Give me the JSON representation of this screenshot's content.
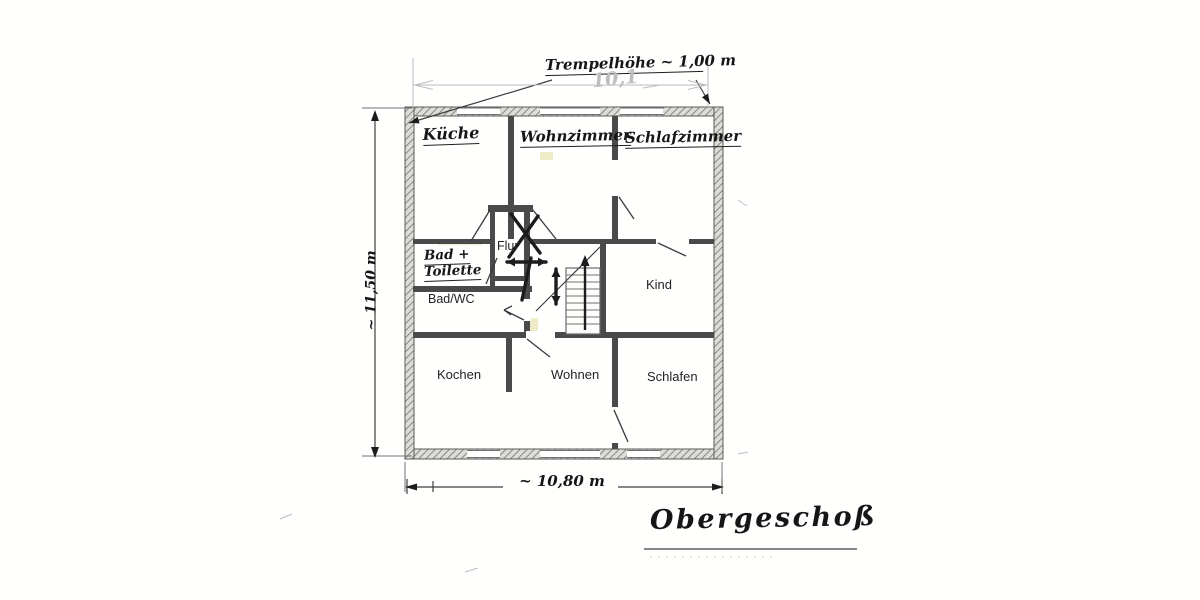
{
  "drawing": {
    "floor_title": "Obergeschoß",
    "knee_wall_note": "Trempelhöhe ~ 1,00 m",
    "dim_top_faint": "10,1",
    "dim_left": "~ 11,50 m",
    "dim_bottom": "~ 10,80 m"
  },
  "rooms": {
    "kueche": "Küche",
    "wohnzimmer": "Wohnzimmer",
    "schlafzimmer": "Schlafzimmer",
    "flur": "Flur",
    "bad_line1": "Bad +",
    "bad_line2": "Toilette",
    "bad_wc": "Bad/WC",
    "kind": "Kind",
    "kochen": "Kochen",
    "wohnen": "Wohnen",
    "schlafen": "Schlafen"
  },
  "colors": {
    "pencil": "#3f3f3f",
    "ink": "#1c1c1c",
    "faint_print": "#bdbdbd",
    "highlight": "#c4bc4d",
    "paper": "#fffffe"
  },
  "plan_geometry": {
    "rects": [
      {
        "x": 438,
        "y": 239,
        "w": 44,
        "h": 6,
        "c": "tint"
      },
      {
        "x": 524,
        "y": 318,
        "w": 14,
        "h": 16,
        "c": "tint"
      },
      {
        "x": 540,
        "y": 152,
        "w": 13,
        "h": 8,
        "c": "tint"
      },
      {
        "x": 405,
        "y": 107,
        "w": 318,
        "h": 9,
        "c": "wo"
      },
      {
        "x": 405,
        "y": 449,
        "w": 318,
        "h": 10,
        "c": "wo"
      },
      {
        "x": 405,
        "y": 107,
        "w": 9,
        "h": 352,
        "c": "wo"
      },
      {
        "x": 714,
        "y": 107,
        "w": 9,
        "h": 352,
        "c": "wo"
      },
      {
        "x": 413,
        "y": 239,
        "w": 77,
        "h": 5,
        "c": "wi"
      },
      {
        "x": 530,
        "y": 239,
        "w": 126,
        "h": 5,
        "c": "wi"
      },
      {
        "x": 689,
        "y": 239,
        "w": 25,
        "h": 5,
        "c": "wi"
      },
      {
        "x": 508,
        "y": 116,
        "w": 6,
        "h": 123,
        "c": "wi"
      },
      {
        "x": 612,
        "y": 116,
        "w": 6,
        "h": 123,
        "c": "wi"
      },
      {
        "x": 413,
        "y": 286,
        "w": 119,
        "h": 6,
        "c": "wi"
      },
      {
        "x": 524,
        "y": 212,
        "w": 6,
        "h": 122,
        "c": "wi"
      },
      {
        "x": 490,
        "y": 212,
        "w": 5,
        "h": 74,
        "c": "wi"
      },
      {
        "x": 488,
        "y": 205,
        "w": 45,
        "h": 7,
        "c": "wi"
      },
      {
        "x": 492,
        "y": 276,
        "w": 38,
        "h": 5,
        "c": "wi"
      },
      {
        "x": 600,
        "y": 244,
        "w": 6,
        "h": 90,
        "c": "wi"
      },
      {
        "x": 413,
        "y": 332,
        "w": 301,
        "h": 6,
        "c": "wi"
      },
      {
        "x": 506,
        "y": 338,
        "w": 6,
        "h": 54,
        "c": "wi"
      },
      {
        "x": 612,
        "y": 338,
        "w": 6,
        "h": 111,
        "c": "wi"
      },
      {
        "x": 457,
        "y": 108,
        "w": 43,
        "h": 7,
        "c": "win"
      },
      {
        "x": 540,
        "y": 108,
        "w": 60,
        "h": 7,
        "c": "win"
      },
      {
        "x": 620,
        "y": 108,
        "w": 43,
        "h": 7,
        "c": "win"
      },
      {
        "x": 467,
        "y": 450,
        "w": 33,
        "h": 8,
        "c": "win"
      },
      {
        "x": 540,
        "y": 450,
        "w": 60,
        "h": 8,
        "c": "win"
      },
      {
        "x": 627,
        "y": 450,
        "w": 33,
        "h": 8,
        "c": "win"
      },
      {
        "x": 611,
        "y": 160,
        "w": 8,
        "h": 36,
        "c": "win"
      },
      {
        "x": 523,
        "y": 299,
        "w": 8,
        "h": 22,
        "c": "win"
      },
      {
        "x": 526,
        "y": 331,
        "w": 29,
        "h": 8,
        "c": "win"
      },
      {
        "x": 611,
        "y": 407,
        "w": 8,
        "h": 36,
        "c": "win"
      },
      {
        "x": 566,
        "y": 268,
        "w": 34,
        "h": 66,
        "c": "st"
      }
    ],
    "lines": [
      {
        "x1": 457,
        "y1": 108,
        "x2": 500,
        "y2": 108,
        "c": "thin"
      },
      {
        "x1": 457,
        "y1": 114.5,
        "x2": 500,
        "y2": 114.5,
        "c": "thin"
      },
      {
        "x1": 540,
        "y1": 108,
        "x2": 600,
        "y2": 108,
        "c": "thin"
      },
      {
        "x1": 540,
        "y1": 114.5,
        "x2": 600,
        "y2": 114.5,
        "c": "thin"
      },
      {
        "x1": 620,
        "y1": 108,
        "x2": 663,
        "y2": 108,
        "c": "thin"
      },
      {
        "x1": 620,
        "y1": 114.5,
        "x2": 663,
        "y2": 114.5,
        "c": "thin"
      },
      {
        "x1": 467,
        "y1": 450.5,
        "x2": 500,
        "y2": 450.5,
        "c": "thin"
      },
      {
        "x1": 467,
        "y1": 457.5,
        "x2": 500,
        "y2": 457.5,
        "c": "thin"
      },
      {
        "x1": 540,
        "y1": 450.5,
        "x2": 600,
        "y2": 450.5,
        "c": "thin"
      },
      {
        "x1": 540,
        "y1": 457.5,
        "x2": 600,
        "y2": 457.5,
        "c": "thin"
      },
      {
        "x1": 627,
        "y1": 450.5,
        "x2": 660,
        "y2": 450.5,
        "c": "thin"
      },
      {
        "x1": 627,
        "y1": 457.5,
        "x2": 660,
        "y2": 457.5,
        "c": "thin"
      },
      {
        "x1": 566,
        "y1": 275,
        "x2": 600,
        "y2": 275,
        "c": "thin"
      },
      {
        "x1": 566,
        "y1": 282,
        "x2": 600,
        "y2": 282,
        "c": "thin"
      },
      {
        "x1": 566,
        "y1": 289,
        "x2": 600,
        "y2": 289,
        "c": "thin"
      },
      {
        "x1": 566,
        "y1": 296,
        "x2": 600,
        "y2": 296,
        "c": "thin"
      },
      {
        "x1": 566,
        "y1": 303,
        "x2": 600,
        "y2": 303,
        "c": "thin"
      },
      {
        "x1": 566,
        "y1": 310,
        "x2": 600,
        "y2": 310,
        "c": "thin"
      },
      {
        "x1": 566,
        "y1": 317,
        "x2": 600,
        "y2": 317,
        "c": "thin"
      },
      {
        "x1": 566,
        "y1": 324,
        "x2": 600,
        "y2": 324,
        "c": "thin"
      },
      {
        "x1": 619,
        "y1": 197,
        "x2": 634,
        "y2": 219,
        "c": "swing"
      },
      {
        "x1": 658,
        "y1": 243,
        "x2": 686,
        "y2": 256,
        "c": "swing"
      },
      {
        "x1": 524,
        "y1": 320,
        "x2": 504,
        "y2": 310,
        "c": "swing"
      },
      {
        "x1": 504,
        "y1": 310,
        "x2": 512,
        "y2": 306,
        "c": "swing"
      },
      {
        "x1": 504,
        "y1": 310,
        "x2": 511,
        "y2": 315,
        "c": "swing"
      },
      {
        "x1": 527,
        "y1": 339,
        "x2": 550,
        "y2": 357,
        "c": "swing"
      },
      {
        "x1": 614,
        "y1": 410,
        "x2": 628,
        "y2": 442,
        "c": "swing"
      },
      {
        "x1": 490,
        "y1": 210,
        "x2": 471,
        "y2": 241,
        "c": "swing"
      },
      {
        "x1": 533,
        "y1": 210,
        "x2": 556,
        "y2": 239,
        "c": "swing"
      },
      {
        "x1": 497,
        "y1": 258,
        "x2": 486,
        "y2": 284,
        "c": "swing"
      },
      {
        "x1": 536,
        "y1": 311,
        "x2": 600,
        "y2": 247,
        "c": "pencil"
      },
      {
        "x1": 585,
        "y1": 330,
        "x2": 585,
        "y2": 262,
        "c": "bold2"
      },
      {
        "x1": 507,
        "y1": 262,
        "x2": 546,
        "y2": 262,
        "c": "bold"
      },
      {
        "x1": 556,
        "y1": 269,
        "x2": 556,
        "y2": 304,
        "c": "bold"
      },
      {
        "x1": 511,
        "y1": 214,
        "x2": 540,
        "y2": 253,
        "c": "bold"
      },
      {
        "x1": 538,
        "y1": 216,
        "x2": 509,
        "y2": 257,
        "c": "bold"
      },
      {
        "x1": 531,
        "y1": 258,
        "x2": 522,
        "y2": 300,
        "c": "bold"
      },
      {
        "x1": 552,
        "y1": 80,
        "x2": 409,
        "y2": 123,
        "c": "pencil"
      },
      {
        "x1": 696,
        "y1": 80,
        "x2": 710,
        "y2": 104,
        "c": "pencil"
      },
      {
        "x1": 375,
        "y1": 113,
        "x2": 375,
        "y2": 455,
        "c": "pencil"
      },
      {
        "x1": 362,
        "y1": 108,
        "x2": 412,
        "y2": 108,
        "c": "thin"
      },
      {
        "x1": 362,
        "y1": 456,
        "x2": 412,
        "y2": 456,
        "c": "thin"
      },
      {
        "x1": 407,
        "y1": 487,
        "x2": 503,
        "y2": 487,
        "c": "pencil"
      },
      {
        "x1": 618,
        "y1": 487,
        "x2": 720,
        "y2": 487,
        "c": "pencil"
      },
      {
        "x1": 407,
        "y1": 479,
        "x2": 407,
        "y2": 494,
        "c": "pencil"
      },
      {
        "x1": 722,
        "y1": 479,
        "x2": 722,
        "y2": 494,
        "c": "pencil"
      },
      {
        "x1": 433,
        "y1": 481,
        "x2": 433,
        "y2": 492,
        "c": "pencil"
      },
      {
        "x1": 405,
        "y1": 462,
        "x2": 405,
        "y2": 492,
        "c": "thin"
      },
      {
        "x1": 722,
        "y1": 462,
        "x2": 722,
        "y2": 492,
        "c": "thin"
      },
      {
        "x1": 413,
        "y1": 58,
        "x2": 413,
        "y2": 107,
        "c": "faint"
      },
      {
        "x1": 708,
        "y1": 58,
        "x2": 708,
        "y2": 107,
        "c": "faint"
      },
      {
        "x1": 413,
        "y1": 85,
        "x2": 708,
        "y2": 85,
        "c": "faint"
      },
      {
        "x1": 415,
        "y1": 85,
        "x2": 433,
        "y2": 80.5,
        "c": "faint"
      },
      {
        "x1": 415,
        "y1": 85,
        "x2": 433,
        "y2": 89.5,
        "c": "faint"
      },
      {
        "x1": 706,
        "y1": 85,
        "x2": 688,
        "y2": 80.5,
        "c": "faint"
      },
      {
        "x1": 706,
        "y1": 85,
        "x2": 688,
        "y2": 89.5,
        "c": "faint"
      },
      {
        "x1": 643,
        "y1": 88,
        "x2": 660,
        "y2": 85,
        "c": "faint"
      },
      {
        "x1": 644,
        "y1": 549,
        "x2": 857,
        "y2": 549,
        "c": "pencil"
      },
      {
        "x1": 650,
        "y1": 557,
        "x2": 772,
        "y2": 557,
        "c": "faintdash"
      },
      {
        "x1": 280,
        "y1": 519,
        "x2": 292,
        "y2": 514,
        "c": "faint"
      },
      {
        "x1": 465,
        "y1": 572,
        "x2": 478,
        "y2": 568,
        "c": "faint"
      },
      {
        "x1": 738,
        "y1": 454,
        "x2": 748,
        "y2": 452,
        "c": "faint"
      },
      {
        "x1": 738,
        "y1": 200,
        "x2": 747,
        "y2": 206,
        "c": "faint"
      }
    ],
    "polys": [
      {
        "p": "375,110 371,121 379,121",
        "c": "fillD"
      },
      {
        "p": "375,458 371,447 379,447",
        "c": "fillD"
      },
      {
        "p": "405,487 417,483.5 417,490.5",
        "c": "fillD"
      },
      {
        "p": "724,487 712,483.5 712,490.5",
        "c": "fillD"
      },
      {
        "p": "409,123 417.6,116.7 419.6,123.4",
        "c": "fillD"
      },
      {
        "p": "710,104 702,97.2 708,93.6",
        "c": "fillD"
      },
      {
        "p": "585,255 580.5,266 589.5,266",
        "c": "fillD"
      },
      {
        "p": "507,262 515,257.5 515,266.5",
        "c": "fillD"
      },
      {
        "p": "546,262 538,257.5 538,266.5",
        "c": "fillD"
      },
      {
        "p": "556,268 551.5,277 560.5,277",
        "c": "fillD"
      },
      {
        "p": "556,305 551.5,296 560.5,296",
        "c": "fillD"
      }
    ]
  }
}
